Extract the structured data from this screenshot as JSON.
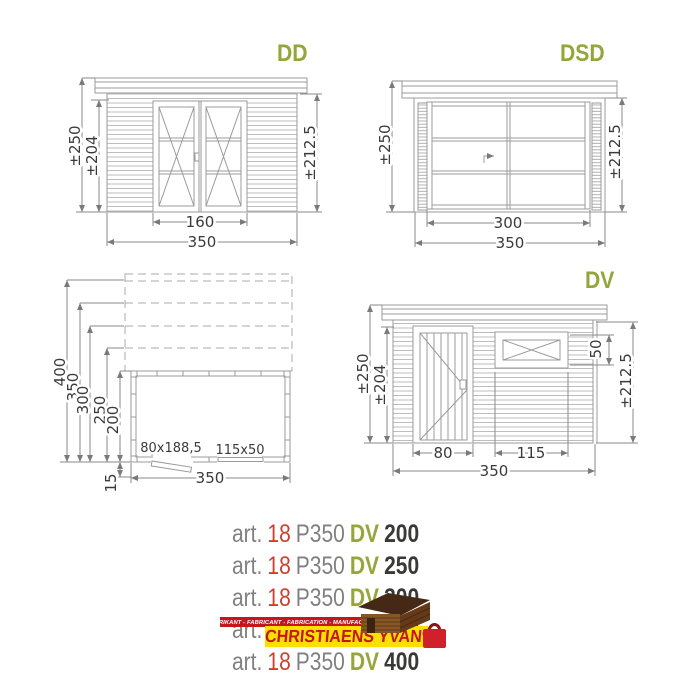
{
  "colors": {
    "accent_green": "#97a53a",
    "accent_red": "#cd3e2d",
    "text_gray": "#808080",
    "text_black": "#393937",
    "logo_red": "#c4161d",
    "logo_yellow": "#ffdf00",
    "line_gray": "#9b9b9b"
  },
  "drawings": {
    "dd": {
      "title": "DD",
      "dims": {
        "height_outer": "±250",
        "height_inner": "±204",
        "height_right": "±212.5",
        "door_width": "160",
        "total_width": "350"
      }
    },
    "dsd": {
      "title": "DSD",
      "dims": {
        "height_left": "±250",
        "height_right": "±212.5",
        "door_width": "300",
        "total_width": "350"
      }
    },
    "plan": {
      "dims": {
        "depth_400": "400",
        "depth_350": "350",
        "depth_300": "300",
        "depth_250": "250",
        "depth_200": "200",
        "front_offset": "15",
        "width": "350",
        "door_size": "80x188,5",
        "window_size": "115x50"
      }
    },
    "dv": {
      "title": "DV",
      "dims": {
        "height_outer": "±250",
        "height_inner": "±204",
        "window_height": "50",
        "height_right": "±212.5",
        "door_width": "80",
        "window_width": "115",
        "total_width": "350"
      }
    }
  },
  "articles": [
    {
      "prefix": "art.",
      "number": "18",
      "model": "P350",
      "series": "DV",
      "size": "200"
    },
    {
      "prefix": "art.",
      "number": "18",
      "model": "P350",
      "series": "DV",
      "size": "250"
    },
    {
      "prefix": "art.",
      "number": "18",
      "model": "P350",
      "series": "DV",
      "size": "300"
    },
    {
      "prefix": "art.",
      "number": "18",
      "model": "P350",
      "series": "DV",
      "size": "350"
    },
    {
      "prefix": "art.",
      "number": "18",
      "model": "P350",
      "series": "DV",
      "size": "400"
    }
  ],
  "logo": {
    "banner": "FABRIKANT - FABRICANT - FABRICATION - MANUFACTURER",
    "name": "CHRISTIAENS YVAN",
    "registered": "®"
  }
}
